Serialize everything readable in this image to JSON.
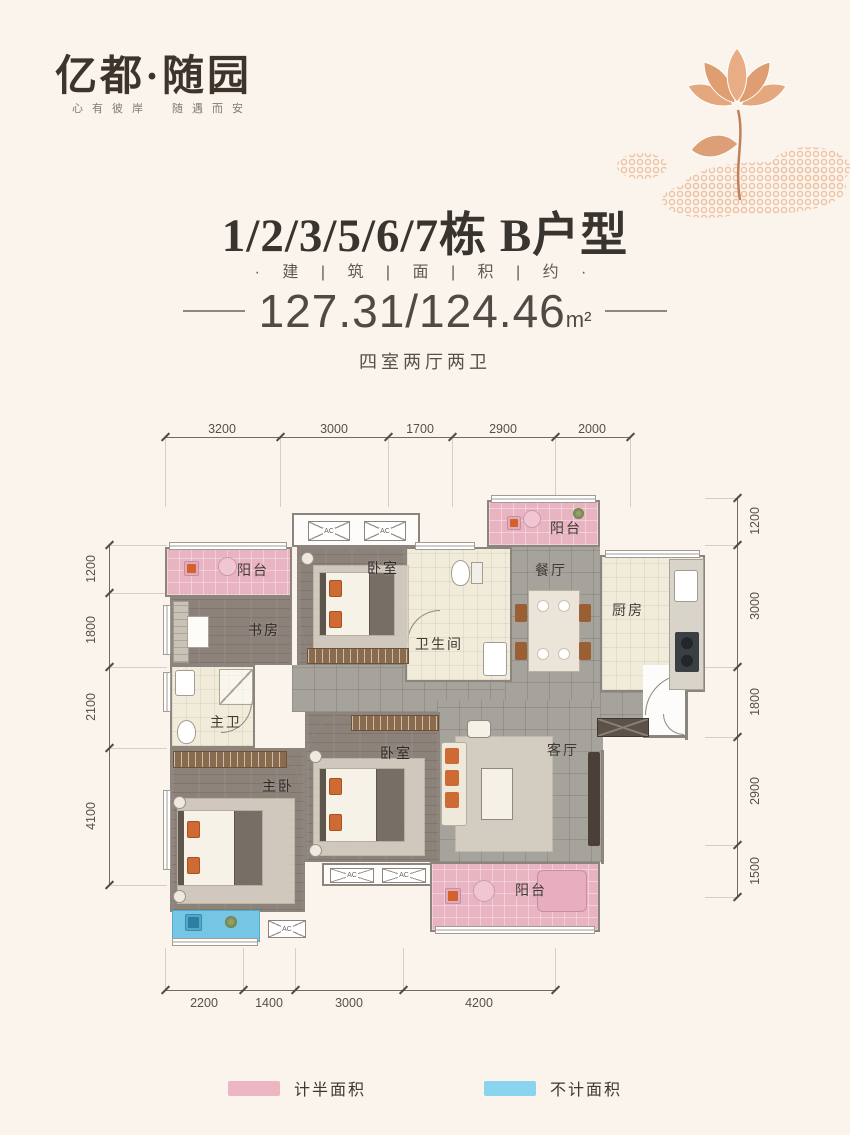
{
  "brand": {
    "logo": "亿都·随园",
    "tagline": "心有彼岸　随遇而安"
  },
  "header": {
    "title": "1/2/3/5/6/7栋 B户型",
    "subtitle": "· 建 | 筑 | 面 | 积 | 约 ·",
    "area": "127.31/124.46",
    "area_unit": "m²",
    "layout": "四室两厅两卫"
  },
  "rooms": {
    "balcony_tl": "阳台",
    "study": "书房",
    "bedroom_top": "卧室",
    "bathroom": "卫生间",
    "dining": "餐厅",
    "kitchen": "厨房",
    "balcony_tr": "阳台",
    "master_bath": "主卫",
    "master_bedroom": "主卧",
    "bedroom_mid": "卧室",
    "living": "客厅",
    "balcony_br": "阳台"
  },
  "ac_label": "AC",
  "dims": {
    "top": [
      "3200",
      "3000",
      "1700",
      "2900",
      "2000"
    ],
    "bottom": [
      "2200",
      "1400",
      "3000",
      "4200"
    ],
    "left": [
      "1200",
      "1800",
      "2100",
      "4100"
    ],
    "right": [
      "1200",
      "3000",
      "1800",
      "2900",
      "1500"
    ]
  },
  "legend": [
    {
      "label": "计半面积",
      "color": "#eeb5c2"
    },
    {
      "label": "不计面积",
      "color": "#8bd4f0"
    }
  ],
  "colors": {
    "background": "#fbf4ec",
    "balcony_pink": "#e9b4c2",
    "uncounted_blue": "#74c6e4",
    "accent_orange": "#ce6a33",
    "title_text": "#38342f"
  }
}
